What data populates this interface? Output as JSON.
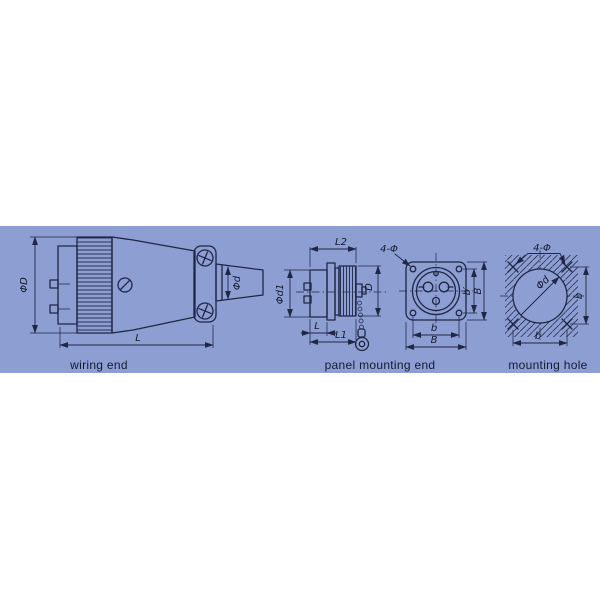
{
  "colors": {
    "page_background": "#ffffff",
    "panel_background": "#8d9ed3",
    "line": "#1f2745",
    "text": "#141b31"
  },
  "views": {
    "wiring_end": {
      "caption": "wiring end",
      "dims": {
        "phi_D": "ΦD",
        "phi_d": "Φd",
        "L": "L"
      }
    },
    "panel_mounting_end": {
      "caption": "panel mounting end",
      "dims": {
        "L2": "L2",
        "phi_d1": "Φd1",
        "D": "D",
        "L": "L",
        "L1": "L1",
        "four_phi": "4-Φ",
        "b_inner": "b′",
        "B_side": "B",
        "b_bottom": "b",
        "B_bottom": "B"
      }
    },
    "mounting_hole": {
      "caption": "mounting hole",
      "dims": {
        "four_phi": "4-Φ",
        "phi_d": "Φd",
        "b_side": "b",
        "b_bottom": "b"
      }
    }
  }
}
